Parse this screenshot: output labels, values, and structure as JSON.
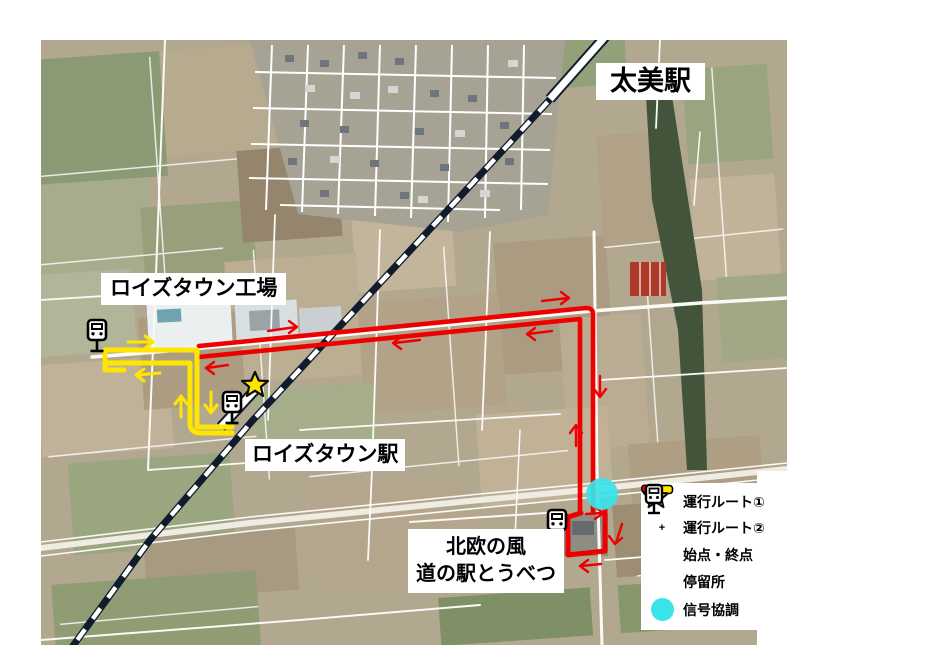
{
  "map": {
    "labels": {
      "futomi_station": "太美駅",
      "royce_town_factory": "ロイズタウン工場",
      "roizu_town_station": "ロイズタウン駅",
      "michinoeki_line1": "北欧の風",
      "michinoeki_line2": "道の駅とうべつ"
    },
    "markers": {
      "bus_stop_count": "3",
      "signal_coordination_count": "1"
    }
  },
  "legend": {
    "plus_sign": "+",
    "items": [
      {
        "label": "運行ルート①",
        "symbol": "yellow-route-line"
      },
      {
        "label": "運行ルート②",
        "symbol": "yellow-plus-red-route-line"
      },
      {
        "label": "始点・終点",
        "symbol": "yellow-star"
      },
      {
        "label": "停留所",
        "symbol": "bus-stop-sign"
      },
      {
        "label": "信号協調",
        "symbol": "cyan-circle"
      }
    ]
  },
  "colors": {
    "route1": "#ffe600",
    "route2": "#ee0000",
    "signal": "#3ae3e8",
    "railway": "#101c2c",
    "star_fill": "#ffe600"
  }
}
